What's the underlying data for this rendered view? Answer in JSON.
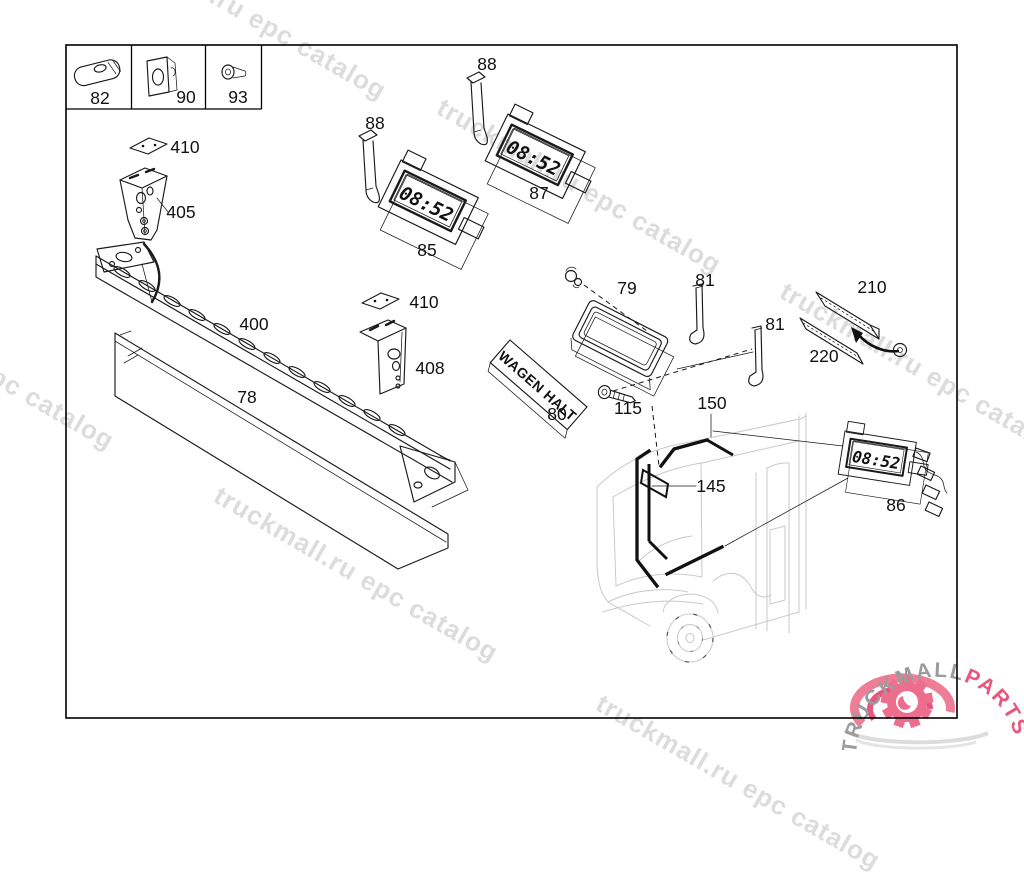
{
  "watermark": {
    "text": "truckmall.ru epc catalog"
  },
  "colors": {
    "watermark_gray": "#dcdcdc",
    "logo_gray": "#9c9c9c",
    "accent_pink": "#e8557e",
    "swirl_pink": "#ee7d98",
    "bus_gray": "#c9c9c9"
  },
  "display": {
    "time": "08:52"
  },
  "sign": {
    "text": "WAGEN HALT"
  },
  "logo": {
    "brand": "TRUCKMALL",
    "suffix": "PARTS"
  },
  "legend": {
    "cells": [
      "82",
      "90",
      "93"
    ]
  },
  "part_labels": {
    "78": "78",
    "79": "79",
    "80": "80",
    "81": "81",
    "82": "82",
    "85": "85",
    "86": "86",
    "87": "87",
    "88": "88",
    "90": "90",
    "93": "93",
    "115": "115",
    "145": "145",
    "150": "150",
    "210": "210",
    "220": "220",
    "400": "400",
    "405": "405",
    "408": "408",
    "410": "410"
  }
}
